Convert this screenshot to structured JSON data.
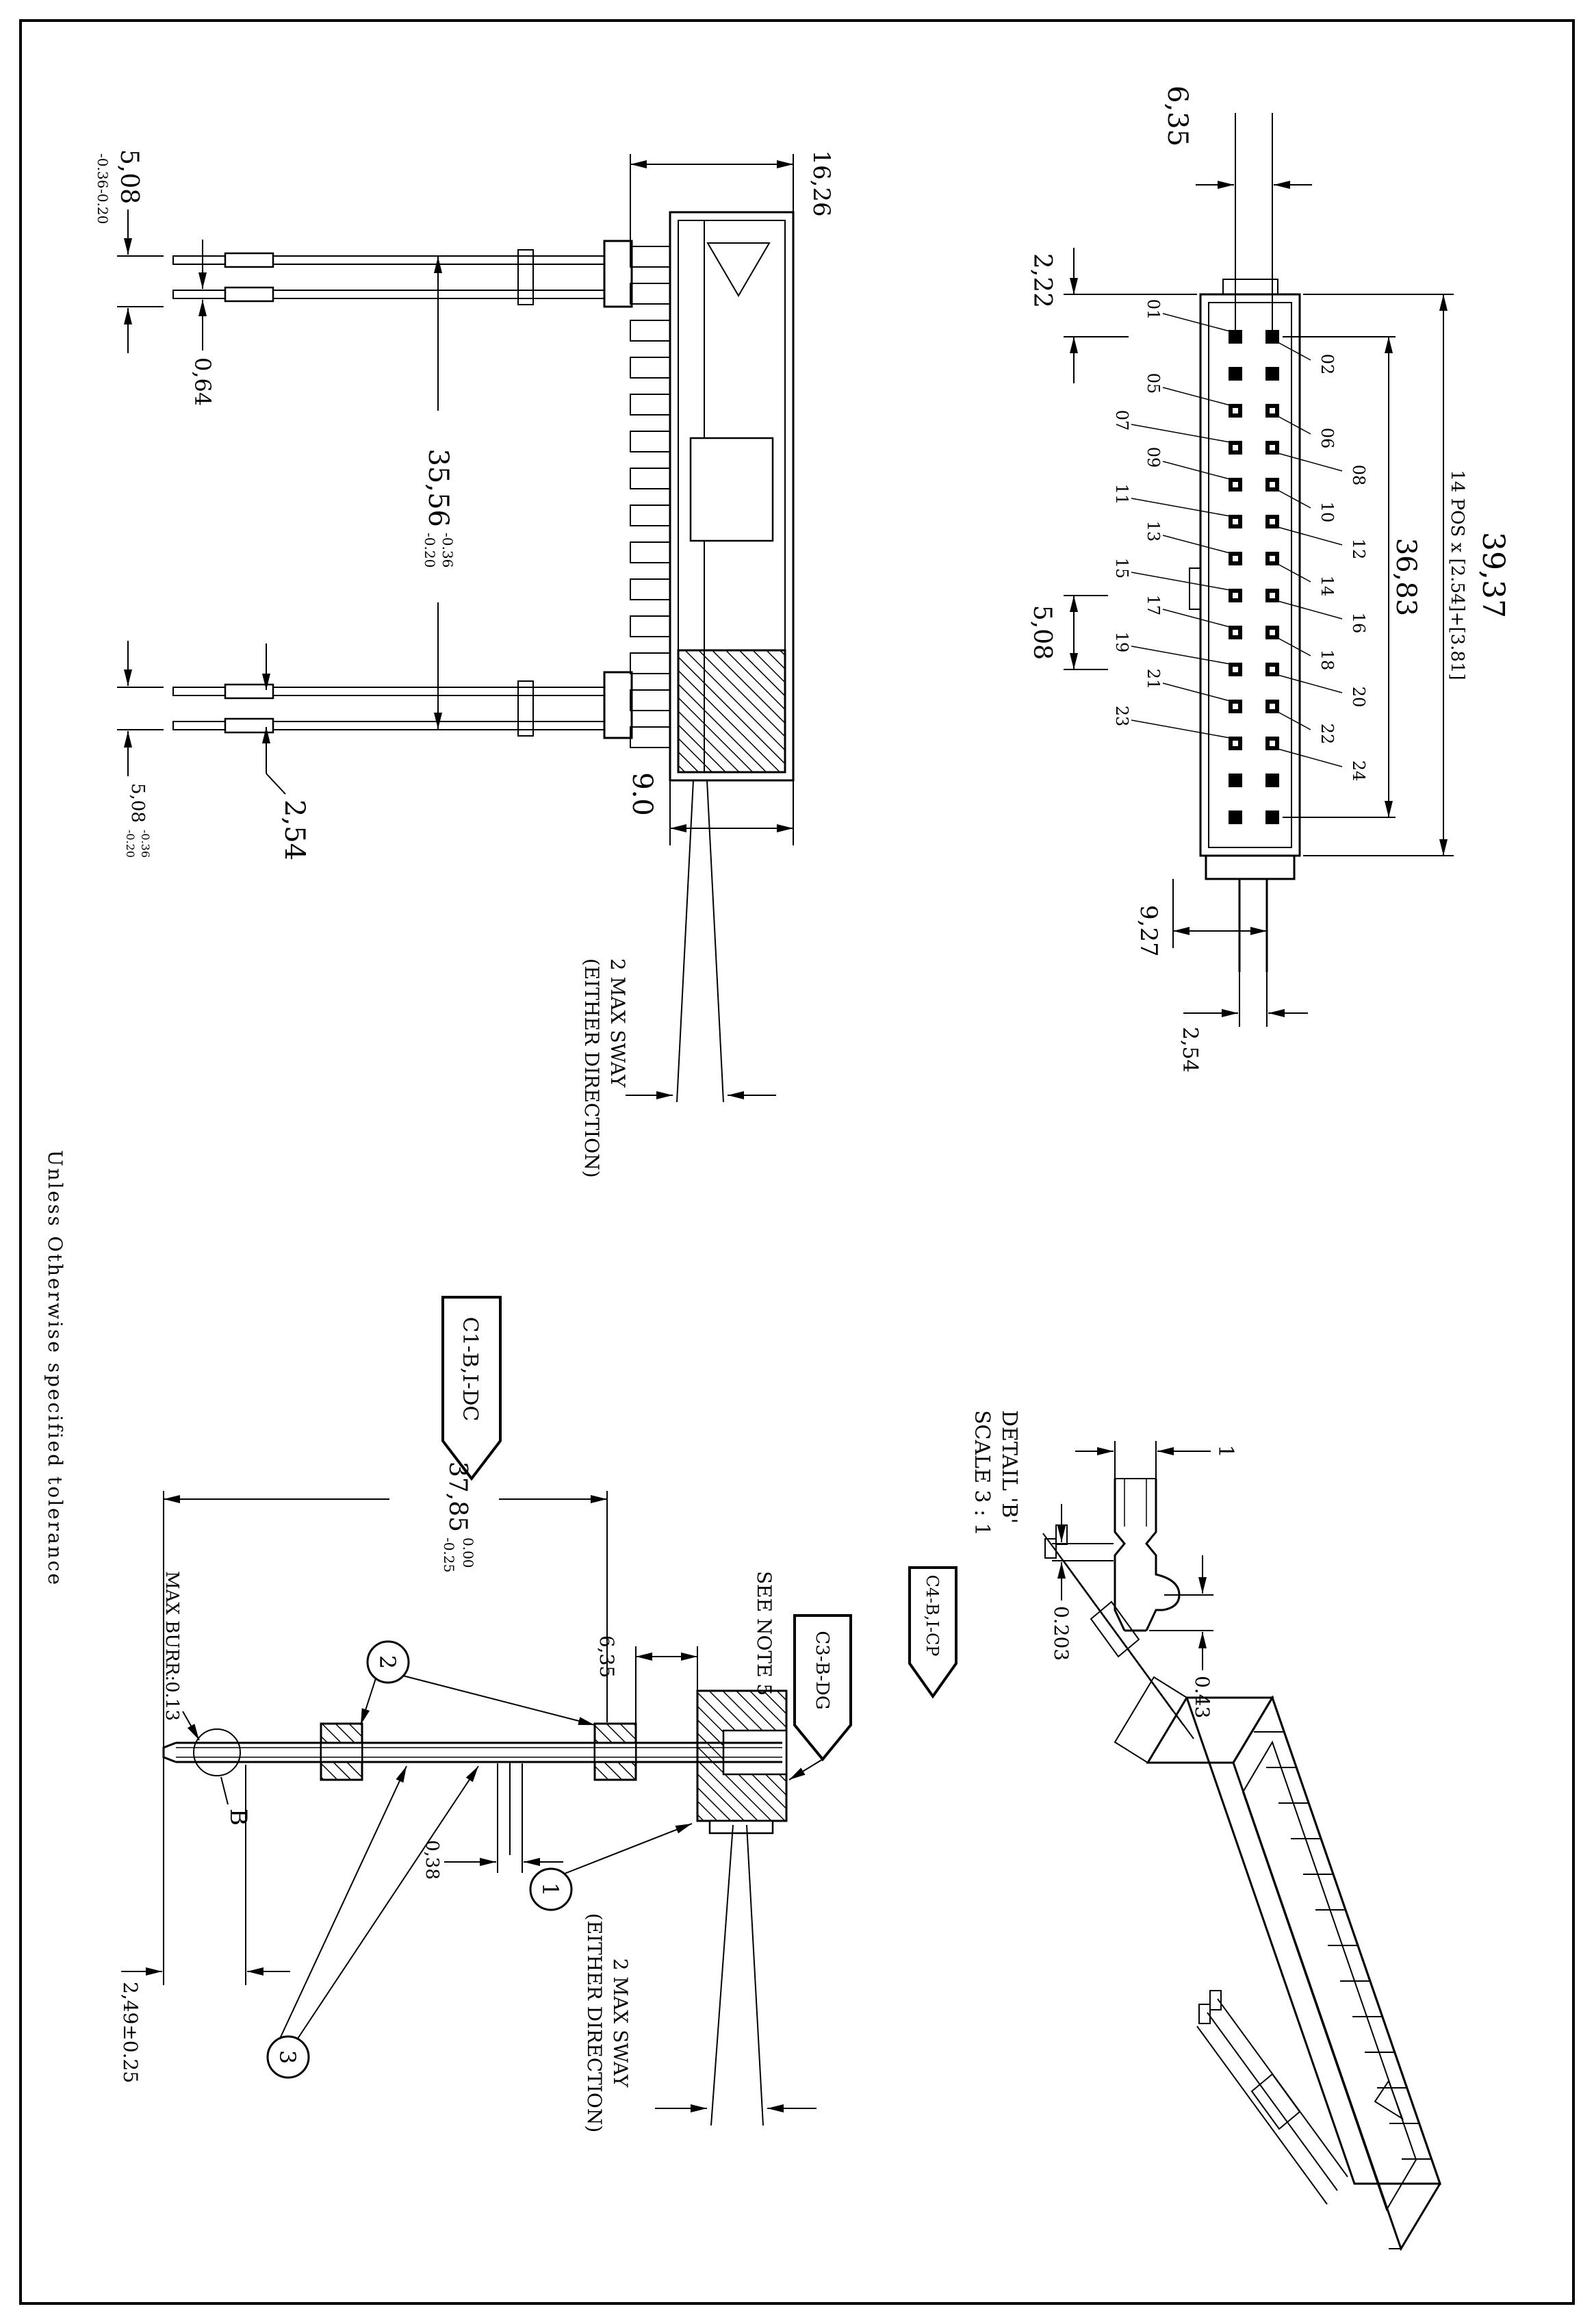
{
  "sheet": {
    "note_tolerance": "Unless Otherwise specified tolerance"
  },
  "plan": {
    "d3937": "39,37",
    "pos_note": "14 POS x [2.54]+[3.81]",
    "d3683": "36,83",
    "d635": "6,35",
    "d222": "2,22",
    "d508": "5,08",
    "d927": "9,27",
    "d254": "2,54",
    "pins_odd": [
      "01",
      "05",
      "07",
      "09",
      "11",
      "13",
      "15",
      "17",
      "19",
      "21",
      "23"
    ],
    "pins_even": [
      "02",
      "06",
      "08",
      "10",
      "12",
      "14",
      "16",
      "18",
      "20",
      "22",
      "24"
    ]
  },
  "front": {
    "d1626": "16,26",
    "d90": "9.0",
    "d3556": "35,56",
    "d508_top": "5,08",
    "d508_bot": "5,08",
    "d064": "0,64",
    "d254": "2,54",
    "tol_hi": "-0.36",
    "tol_lo": "-0.20",
    "sway1": "2 MAX SWAY",
    "sway2": "(EITHER DIRECTION)"
  },
  "assembly": {
    "flag_c1": "C1-B,I-DC",
    "d3785": "37,85",
    "tol_hi": "0.00",
    "tol_lo": "-0.25",
    "d635": "6,35",
    "see_note": "SEE NOTE 5",
    "flag_c3": "C3-B-DG",
    "max_burr": "MAX BURR:0.13",
    "datum": "B",
    "b1": "1",
    "b2": "2",
    "b3": "3",
    "d038": "0,38",
    "d249": "2,49±0.25",
    "sway1": "2 MAX SWAY",
    "sway2": "(EITHER DIRECTION)"
  },
  "detail": {
    "title": "DETAIL 'B'",
    "scale": "SCALE 3 : 1",
    "d1": "1",
    "d043": "0.43",
    "d0203": "0.203",
    "flag_c4": "C4-B,I-CP"
  }
}
